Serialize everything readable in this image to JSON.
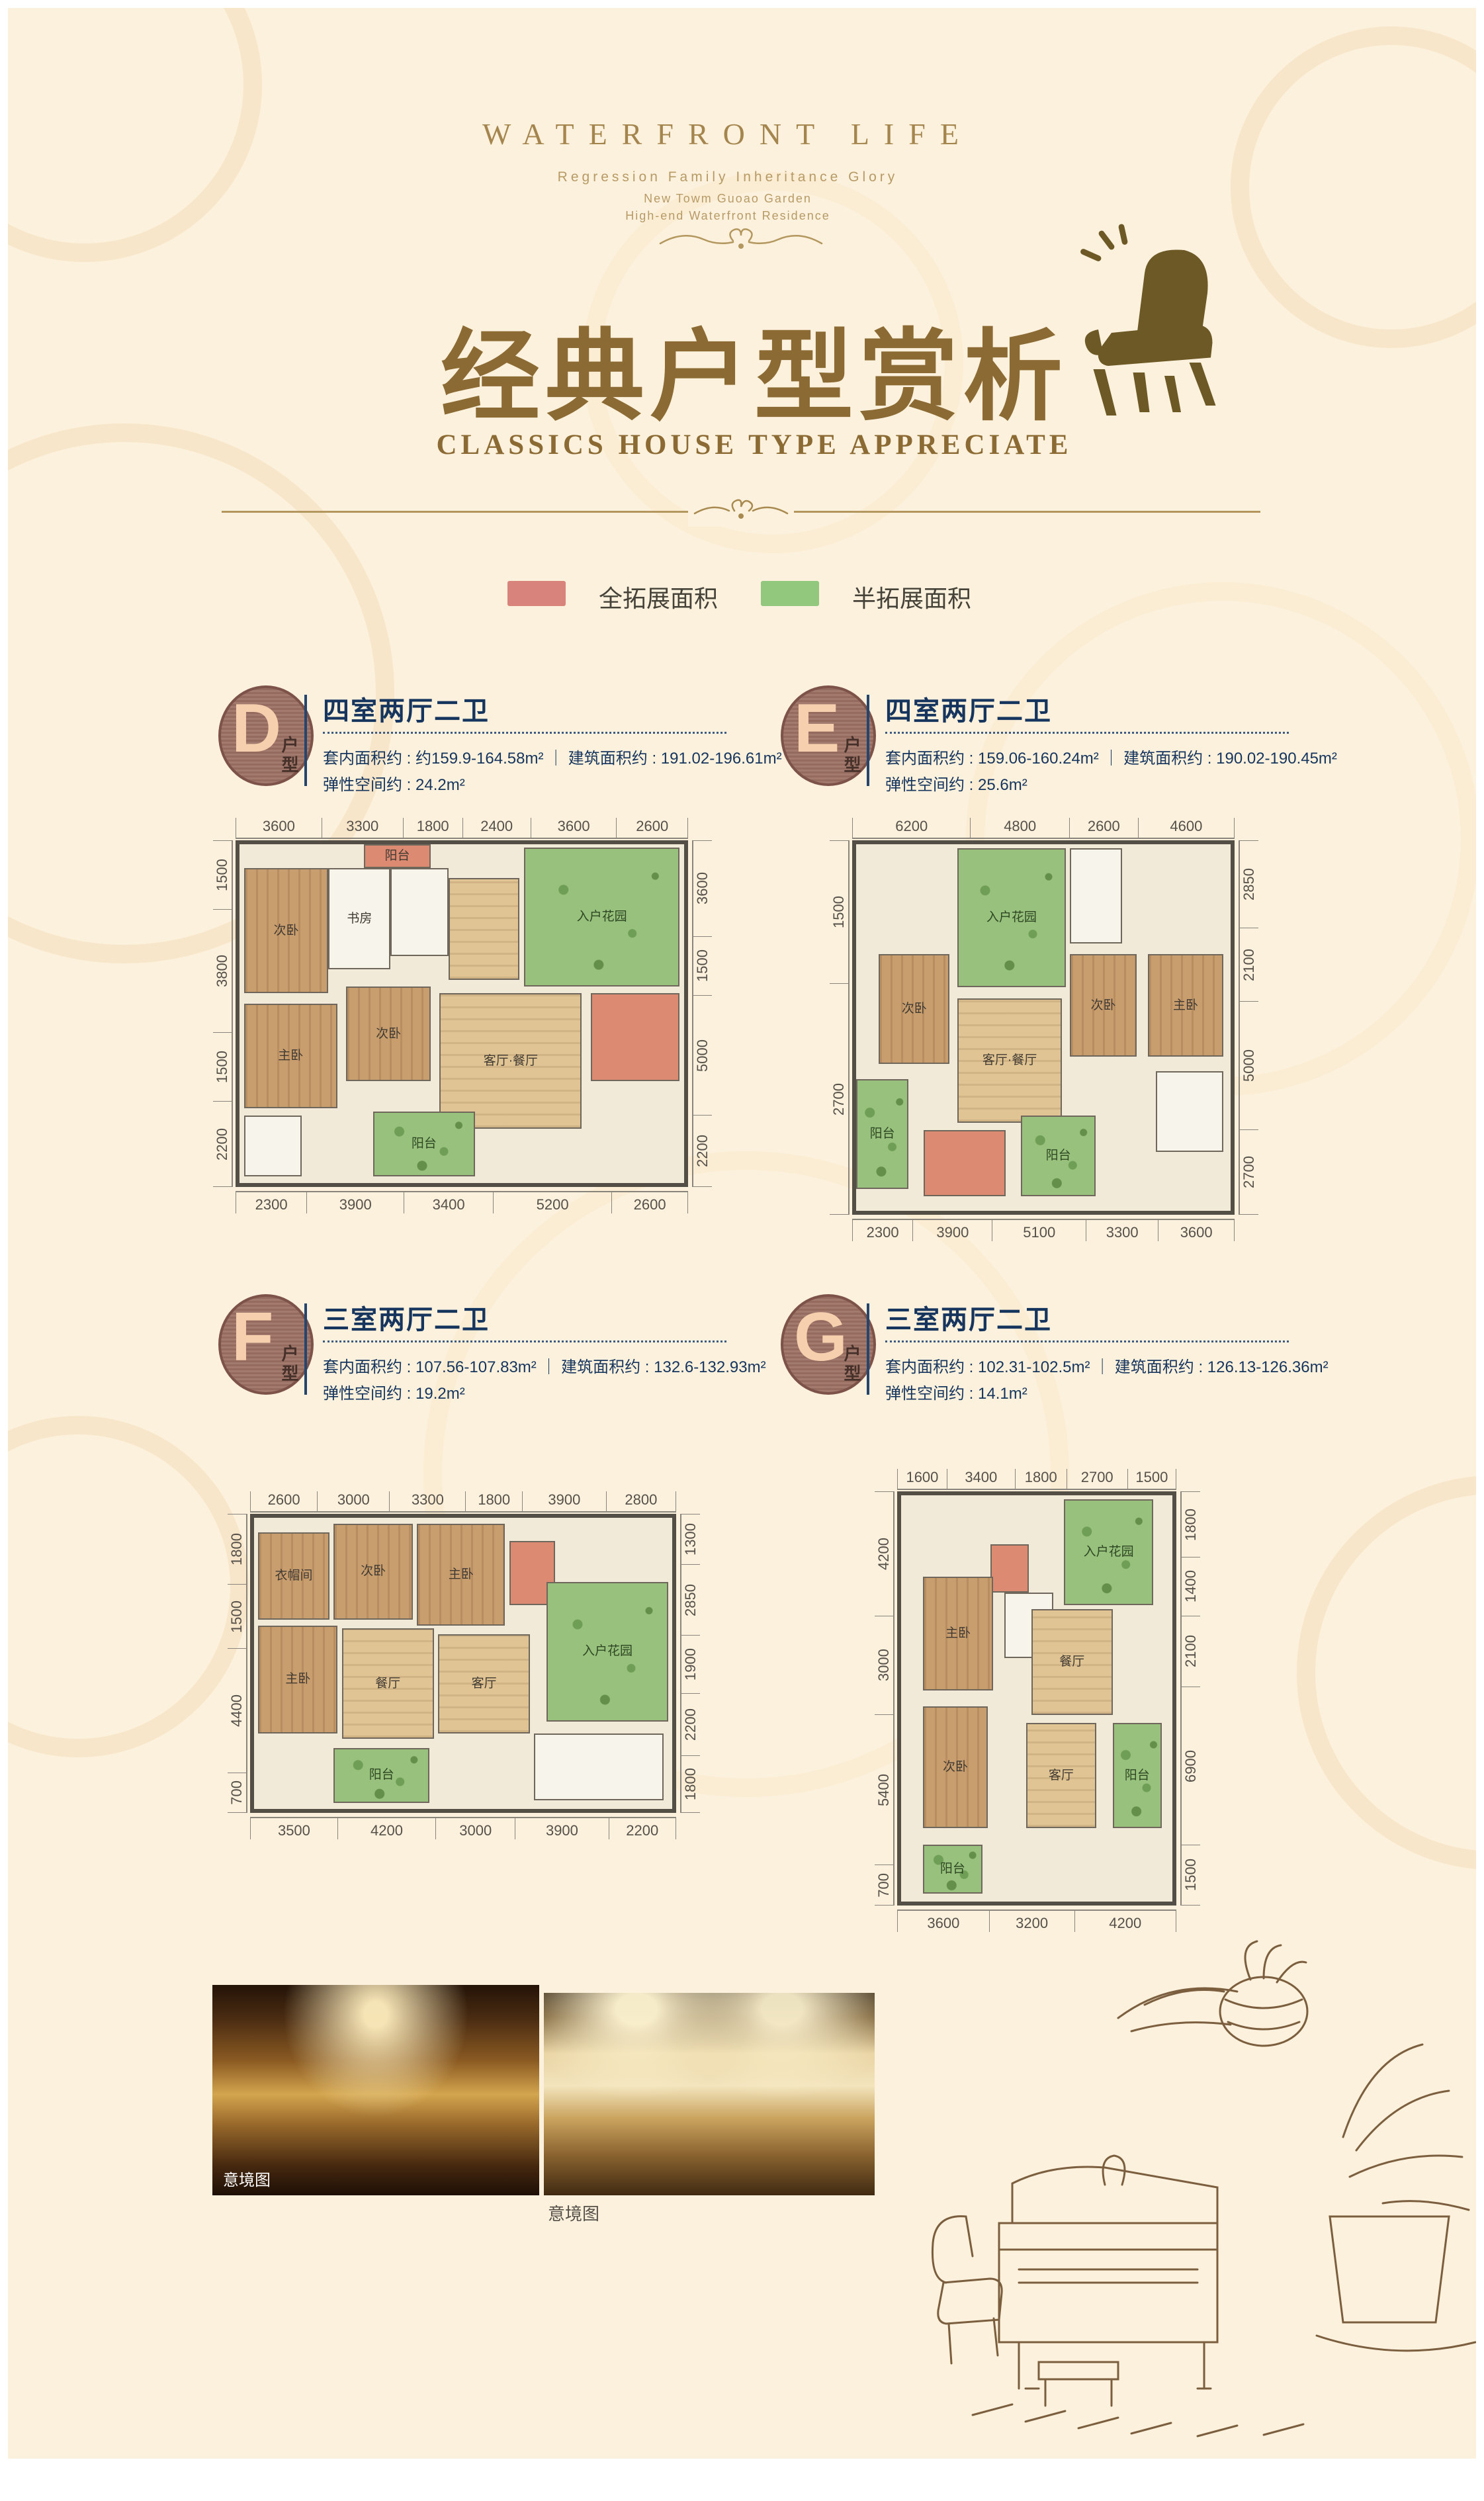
{
  "header": {
    "brand": "WATERFRONT LIFE",
    "tagline": "Regression Family Inheritance Glory",
    "line2": "New Towm Guoao Garden",
    "line3": "High-end Waterfront Residence"
  },
  "title": {
    "cn": "经典户型赏析",
    "en": "CLASSICS HOUSE TYPE APPRECIATE"
  },
  "colors": {
    "gold": "#8c6a33",
    "navy": "#16355e",
    "legend_full": "#d8837b",
    "legend_half": "#92c87e"
  },
  "legend": {
    "full_label": "全拓展面积",
    "half_label": "半拓展面积"
  },
  "units": {
    "D": {
      "letter": "D",
      "suffix": "户型",
      "layout": "四室两厅二卫",
      "line1": "套内面积约 : 约159.9-164.58m²  ｜  建筑面积约 : 191.02-196.61m²",
      "line2": "弹性空间约 : 24.2m²",
      "dims_top": [
        3600,
        3300,
        1800,
        2400,
        3600,
        2600
      ],
      "dims_bottom": [
        2300,
        3900,
        3400,
        5200,
        2600
      ],
      "dims_left": [
        1500,
        3800,
        1500,
        2200
      ],
      "dims_right": [
        3600,
        1500,
        5000,
        2200
      ],
      "rooms": [
        {
          "x": 1,
          "y": 7,
          "w": 19,
          "h": 37,
          "t": "tan",
          "label": "次卧"
        },
        {
          "x": 20,
          "y": 7,
          "w": 14,
          "h": 30,
          "t": "white",
          "label": "书房"
        },
        {
          "x": 34,
          "y": 7,
          "w": 13,
          "h": 26,
          "t": "white"
        },
        {
          "x": 28,
          "y": 0,
          "w": 15,
          "h": 7,
          "t": "salmon",
          "label": "阳台"
        },
        {
          "x": 64,
          "y": 1,
          "w": 35,
          "h": 41,
          "t": "green",
          "label": "入户花园"
        },
        {
          "x": 47,
          "y": 10,
          "w": 16,
          "h": 30,
          "t": "wood"
        },
        {
          "x": 1,
          "y": 47,
          "w": 21,
          "h": 31,
          "t": "tan",
          "label": "主卧"
        },
        {
          "x": 24,
          "y": 42,
          "w": 19,
          "h": 28,
          "t": "tan",
          "label": "次卧"
        },
        {
          "x": 45,
          "y": 44,
          "w": 32,
          "h": 40,
          "t": "wood",
          "label": "客厅·餐厅"
        },
        {
          "x": 79,
          "y": 44,
          "w": 20,
          "h": 26,
          "t": "salmon"
        },
        {
          "x": 1,
          "y": 80,
          "w": 13,
          "h": 18,
          "t": "white"
        },
        {
          "x": 30,
          "y": 79,
          "w": 23,
          "h": 19,
          "t": "green",
          "label": "阳台"
        }
      ]
    },
    "E": {
      "letter": "E",
      "suffix": "户型",
      "layout": "四室两厅二卫",
      "line1": "套内面积约 : 159.06-160.24m²  ｜  建筑面积约 : 190.02-190.45m²",
      "line2": "弹性空间约 : 25.6m²",
      "dims_top": [
        6200,
        4800,
        2600,
        4600
      ],
      "dims_bottom": [
        2300,
        3900,
        5100,
        3300,
        3600
      ],
      "dims_left": [
        1500,
        2700
      ],
      "dims_right": [
        2850,
        2100,
        5000,
        2700
      ],
      "rooms": [
        {
          "x": 27,
          "y": 1,
          "w": 29,
          "h": 38,
          "t": "green",
          "label": "入户花园"
        },
        {
          "x": 57,
          "y": 1,
          "w": 14,
          "h": 26,
          "t": "white"
        },
        {
          "x": 6,
          "y": 30,
          "w": 19,
          "h": 30,
          "t": "tan",
          "label": "次卧"
        },
        {
          "x": 57,
          "y": 30,
          "w": 18,
          "h": 28,
          "t": "tan",
          "label": "次卧"
        },
        {
          "x": 78,
          "y": 30,
          "w": 20,
          "h": 28,
          "t": "tan",
          "label": "主卧"
        },
        {
          "x": 27,
          "y": 42,
          "w": 28,
          "h": 34,
          "t": "wood",
          "label": "客厅·餐厅"
        },
        {
          "x": 0,
          "y": 64,
          "w": 14,
          "h": 30,
          "t": "green",
          "label": "阳台"
        },
        {
          "x": 80,
          "y": 62,
          "w": 18,
          "h": 22,
          "t": "white"
        },
        {
          "x": 18,
          "y": 78,
          "w": 22,
          "h": 18,
          "t": "salmon"
        },
        {
          "x": 44,
          "y": 74,
          "w": 20,
          "h": 22,
          "t": "green",
          "label": "阳台"
        }
      ]
    },
    "F": {
      "letter": "F",
      "suffix": "户型",
      "layout": "三室两厅二卫",
      "line1": "套内面积约 : 107.56-107.83m²  ｜  建筑面积约 : 132.6-132.93m²",
      "line2": "弹性空间约 : 19.2m²",
      "dims_top": [
        2600,
        3000,
        3300,
        1800,
        3900,
        2800
      ],
      "dims_bottom": [
        3500,
        4200,
        3000,
        3900,
        2200
      ],
      "dims_left": [
        1800,
        1500,
        4400,
        700
      ],
      "dims_right": [
        1300,
        2850,
        1900,
        2200,
        1800
      ],
      "rooms": [
        {
          "x": 1,
          "y": 5,
          "w": 17,
          "h": 30,
          "t": "tan",
          "label": "衣帽间"
        },
        {
          "x": 19,
          "y": 2,
          "w": 19,
          "h": 33,
          "t": "tan",
          "label": "次卧"
        },
        {
          "x": 39,
          "y": 2,
          "w": 21,
          "h": 35,
          "t": "tan",
          "label": "主卧"
        },
        {
          "x": 61,
          "y": 8,
          "w": 11,
          "h": 22,
          "t": "salmon"
        },
        {
          "x": 70,
          "y": 22,
          "w": 29,
          "h": 48,
          "t": "green",
          "label": "入户花园"
        },
        {
          "x": 1,
          "y": 37,
          "w": 19,
          "h": 37,
          "t": "tan",
          "label": "主卧"
        },
        {
          "x": 21,
          "y": 38,
          "w": 22,
          "h": 38,
          "t": "wood",
          "label": "餐厅"
        },
        {
          "x": 44,
          "y": 40,
          "w": 22,
          "h": 34,
          "t": "wood",
          "label": "客厅"
        },
        {
          "x": 19,
          "y": 79,
          "w": 23,
          "h": 19,
          "t": "green",
          "label": "阳台"
        },
        {
          "x": 67,
          "y": 74,
          "w": 31,
          "h": 23,
          "t": "white"
        }
      ]
    },
    "G": {
      "letter": "G",
      "suffix": "户型",
      "layout": "三室两厅二卫",
      "line1": "套内面积约 : 102.31-102.5m²  ｜  建筑面积约 : 126.13-126.36m²",
      "line2": "弹性空间约 : 14.1m²",
      "dims_top": [
        1600,
        3400,
        1800,
        2700,
        1500
      ],
      "dims_bottom": [
        3600,
        3200,
        4200
      ],
      "dims_left": [
        4200,
        3000,
        5400,
        700
      ],
      "dims_right": [
        1800,
        1400,
        2100,
        6900,
        1500
      ],
      "rooms": [
        {
          "x": 60,
          "y": 1,
          "w": 33,
          "h": 26,
          "t": "green",
          "label": "入户花园"
        },
        {
          "x": 33,
          "y": 12,
          "w": 14,
          "h": 12,
          "t": "salmon"
        },
        {
          "x": 8,
          "y": 20,
          "w": 26,
          "h": 28,
          "t": "tan",
          "label": "主卧"
        },
        {
          "x": 38,
          "y": 24,
          "w": 18,
          "h": 16,
          "t": "white"
        },
        {
          "x": 48,
          "y": 28,
          "w": 30,
          "h": 26,
          "t": "wood",
          "label": "餐厅"
        },
        {
          "x": 8,
          "y": 52,
          "w": 24,
          "h": 30,
          "t": "tan",
          "label": "次卧"
        },
        {
          "x": 46,
          "y": 56,
          "w": 26,
          "h": 26,
          "t": "wood",
          "label": "客厅"
        },
        {
          "x": 78,
          "y": 56,
          "w": 18,
          "h": 26,
          "t": "green",
          "label": "阳台"
        },
        {
          "x": 8,
          "y": 86,
          "w": 22,
          "h": 12,
          "t": "green",
          "label": "阳台"
        }
      ]
    }
  },
  "photos": {
    "label_1": "意境图",
    "label_2": "意境图"
  }
}
